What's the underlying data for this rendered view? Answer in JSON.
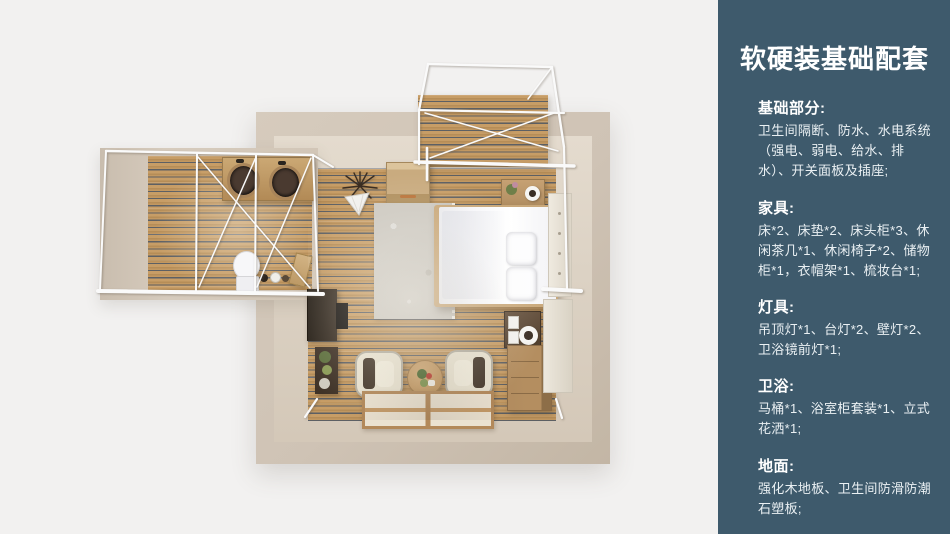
{
  "slide": {
    "background": "#eeedec"
  },
  "panel": {
    "background": "#3e5a6c",
    "text_color": "#ffffff",
    "title": "软硬装基础配套",
    "sections": [
      {
        "heading": "基础部分:",
        "body": "卫生间隔断、防水、水电系统（强电、弱电、给水、排水）、开关面板及插座;"
      },
      {
        "heading": "家具:",
        "body": "床*2、床垫*2、床头柜*3、休闲茶几*1、休闲椅子*2、储物柜*1，衣帽架*1、梳妆台*1;"
      },
      {
        "heading": "灯具:",
        "body": "吊顶灯*1、台灯*2、壁灯*2、卫浴镜前灯*1;"
      },
      {
        "heading": "卫浴:",
        "body": "马桶*1、浴室柜套装*1、立式花洒*1;"
      },
      {
        "heading": "地面:",
        "body": "强化木地板、卫生间防滑防潮石塑板;"
      }
    ]
  },
  "floorplan": {
    "type": "top-down 3D render of a bedroom suite",
    "rooms": [
      "bedroom",
      "bathroom-wing",
      "balcony-deck"
    ],
    "colors": {
      "wall_outer": "#cfc3b5",
      "wall_inner": "#ddd3c5",
      "wood_plank": "#c79d66",
      "plank_gap": "#5d6064",
      "steel_frame": "#fafafa",
      "bed": "#ffffff",
      "rug": "#cdc9c1",
      "armchair": "#e9e3d1",
      "dresser": "#b48e60"
    },
    "items": [
      "bed",
      "pillows",
      "rug",
      "wall-cabinet",
      "nightstand",
      "dark-nightstand",
      "dresser",
      "vanity-panels",
      "desk",
      "monitor",
      "plant-shelf",
      "armchair-left",
      "armchair-right",
      "round-coffee-table",
      "tatami-mats",
      "dried-plant",
      "cone-lamp",
      "bathroom-counter",
      "basin-left",
      "basin-right",
      "toilet",
      "bath-accessories",
      "coat-rack",
      "white-steel-frames"
    ]
  }
}
